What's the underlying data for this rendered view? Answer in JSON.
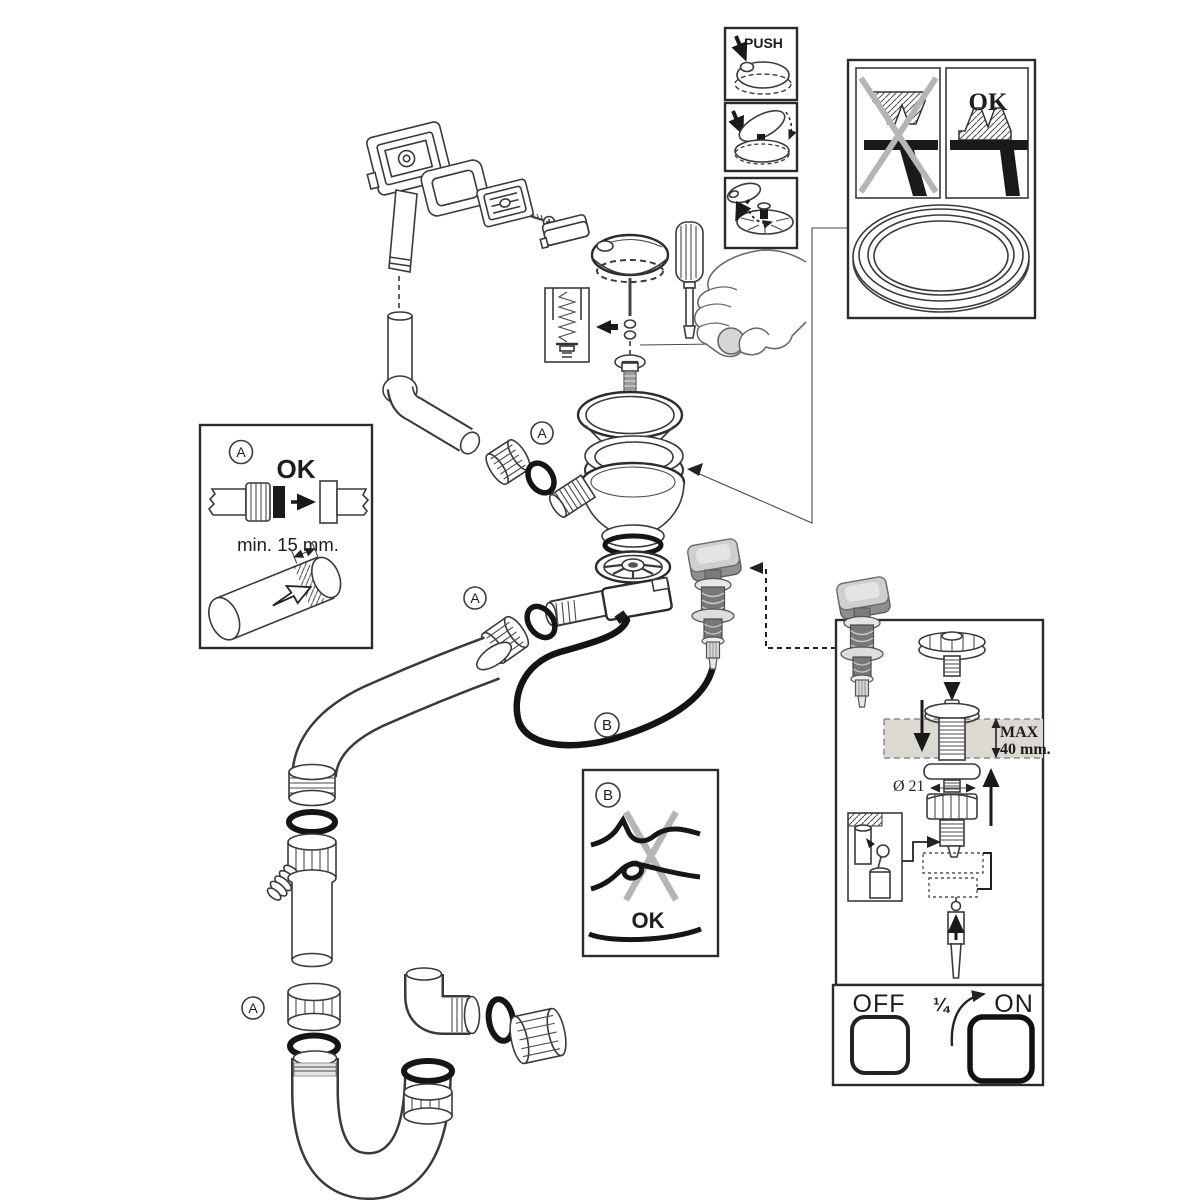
{
  "diagram": {
    "kind": "exploded installation diagram",
    "subject": "sink pop-up waste, overflow and siphon kit"
  },
  "callouts": {
    "a": "A",
    "b": "B"
  },
  "push_sequence": {
    "push_label": "PUSH"
  },
  "seal_panel": {
    "ok_label": "OK"
  },
  "fitting_box": {
    "callout": "A",
    "ok_label": "OK",
    "min_insertion": "min. 15 mm."
  },
  "cable_box": {
    "callout": "B",
    "ok_label": "OK"
  },
  "actuator_panel": {
    "max_line1": "MAX",
    "max_line2": "40 mm.",
    "diameter_label": "Ø 21"
  },
  "valve_box": {
    "off_label": "OFF",
    "turn_label": "¼",
    "on_label": "ON"
  },
  "colors": {
    "line": "#3a3a3a",
    "rubber_black": "#151515",
    "knob_gray": "#cfcfcf",
    "barrel_gray": "#787878",
    "cross_gray": "#b5b5b5",
    "band_gray": "#dcd8d2",
    "paper": "#ffffff"
  }
}
